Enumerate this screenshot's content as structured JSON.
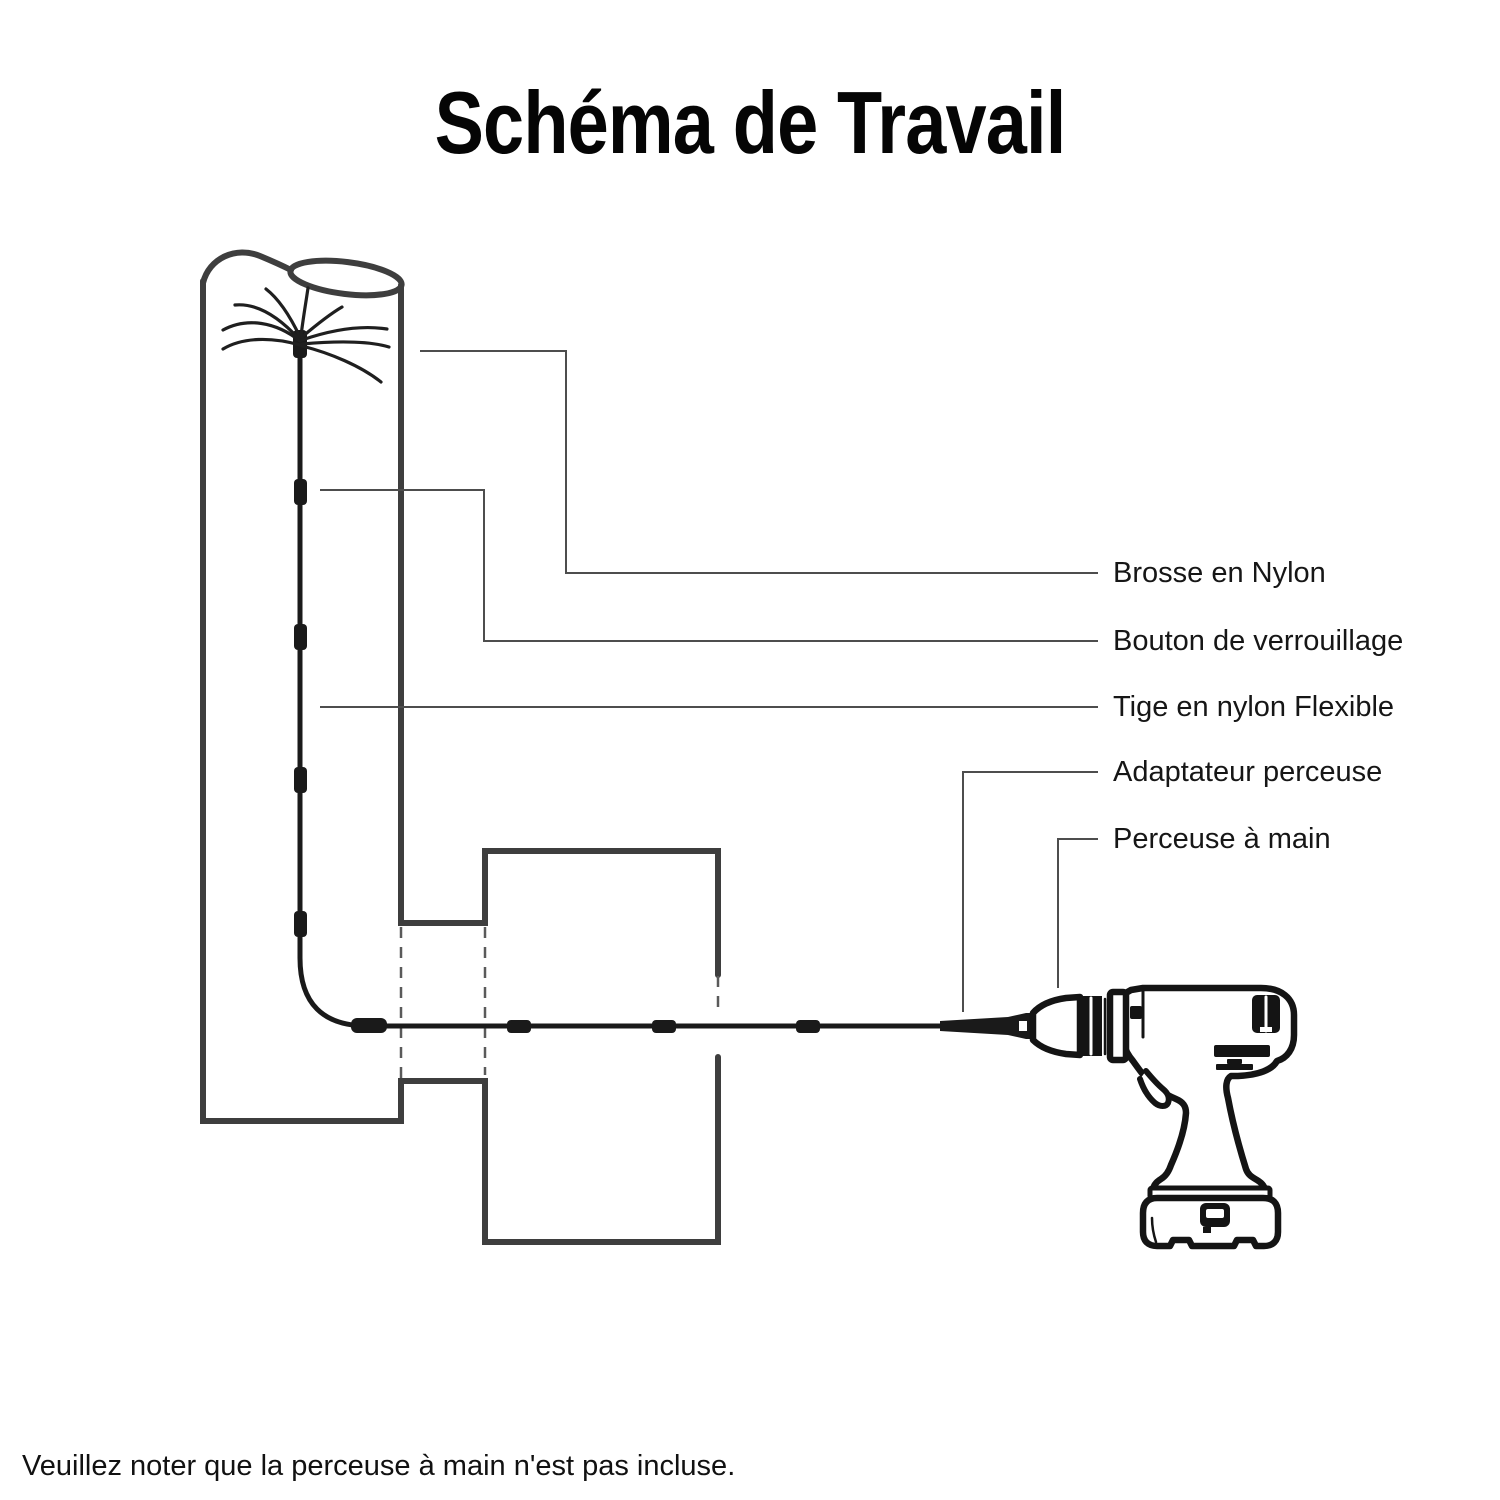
{
  "title": "Schéma de Travail",
  "footnote": "Veuillez noter que la perceuse à main n'est pas incluse.",
  "labels": [
    {
      "id": "brosse",
      "text": "Brosse en Nylon"
    },
    {
      "id": "bouton",
      "text": "Bouton de verrouillage"
    },
    {
      "id": "tige",
      "text": "Tige en nylon Flexible"
    },
    {
      "id": "adaptateur",
      "text": "Adaptateur perceuse"
    },
    {
      "id": "perceuse",
      "text": "Perceuse à main"
    }
  ],
  "colors": {
    "outline": "#3e3e3e",
    "rod": "#1a1a1a",
    "drill": "#141414",
    "leader": "#4d4d4d",
    "dash": "#5a5a5a",
    "text": "#161616",
    "background": "#ffffff"
  }
}
